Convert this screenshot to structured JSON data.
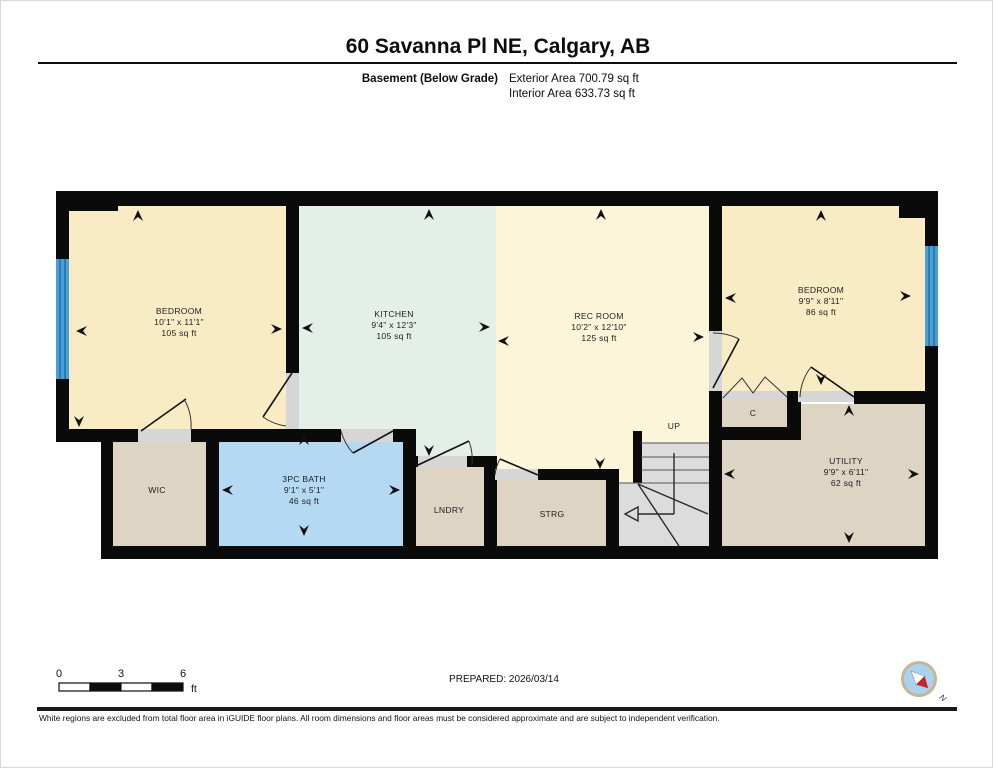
{
  "header": {
    "title": "60 Savanna Pl NE, Calgary, AB",
    "floor_label": "Basement (Below Grade)",
    "exterior_area": "Exterior Area 700.79 sq ft",
    "interior_area": "Interior Area 633.73 sq ft"
  },
  "rooms": {
    "bedroom_left": {
      "name": "BEDROOM",
      "dims": "10'1\" x 11'1\"",
      "area": "105 sq ft"
    },
    "kitchen": {
      "name": "KITCHEN",
      "dims": "9'4\" x 12'3\"",
      "area": "105 sq ft"
    },
    "rec_room": {
      "name": "REC ROOM",
      "dims": "10'2\" x 12'10\"",
      "area": "125 sq ft"
    },
    "bedroom_right": {
      "name": "BEDROOM",
      "dims": "9'9\" x 8'11\"",
      "area": "86 sq ft"
    },
    "bath": {
      "name": "3PC BATH",
      "dims": "9'1\" x 5'1\"",
      "area": "46 sq ft"
    },
    "utility": {
      "name": "UTILITY",
      "dims": "9'9\" x 6'11\"",
      "area": "62 sq ft"
    },
    "wic": {
      "name": "WIC"
    },
    "laundry": {
      "name": "LNDRY"
    },
    "storage": {
      "name": "STRG"
    },
    "closet": {
      "name": "C"
    },
    "stairs": {
      "label": "UP"
    }
  },
  "scale_bar": {
    "ticks": [
      "0",
      "3",
      "6"
    ],
    "unit": "ft"
  },
  "footer": {
    "prepared": "PREPARED: 2026/03/14",
    "compass_n": "N",
    "disclaimer": "White regions are excluded from total floor area in iGUIDE floor plans. All room dimensions and floor areas must be considered approximate and are subject to independent verification."
  },
  "colors": {
    "wall": "#0a0a0a",
    "bedroom_fill": "#f9ecc5",
    "kitchen_fill": "#e4efe7",
    "rec_room_fill": "#fcf5da",
    "bath_fill": "#b5d9f3",
    "utility_fill": "#ddd4c3",
    "stairs_fill": "#dcdcdc",
    "window_blue": "#4aa0d6",
    "door_gap": "#d6d6d6",
    "compass_red": "#cc2222",
    "compass_blue": "#a8d2ee"
  }
}
